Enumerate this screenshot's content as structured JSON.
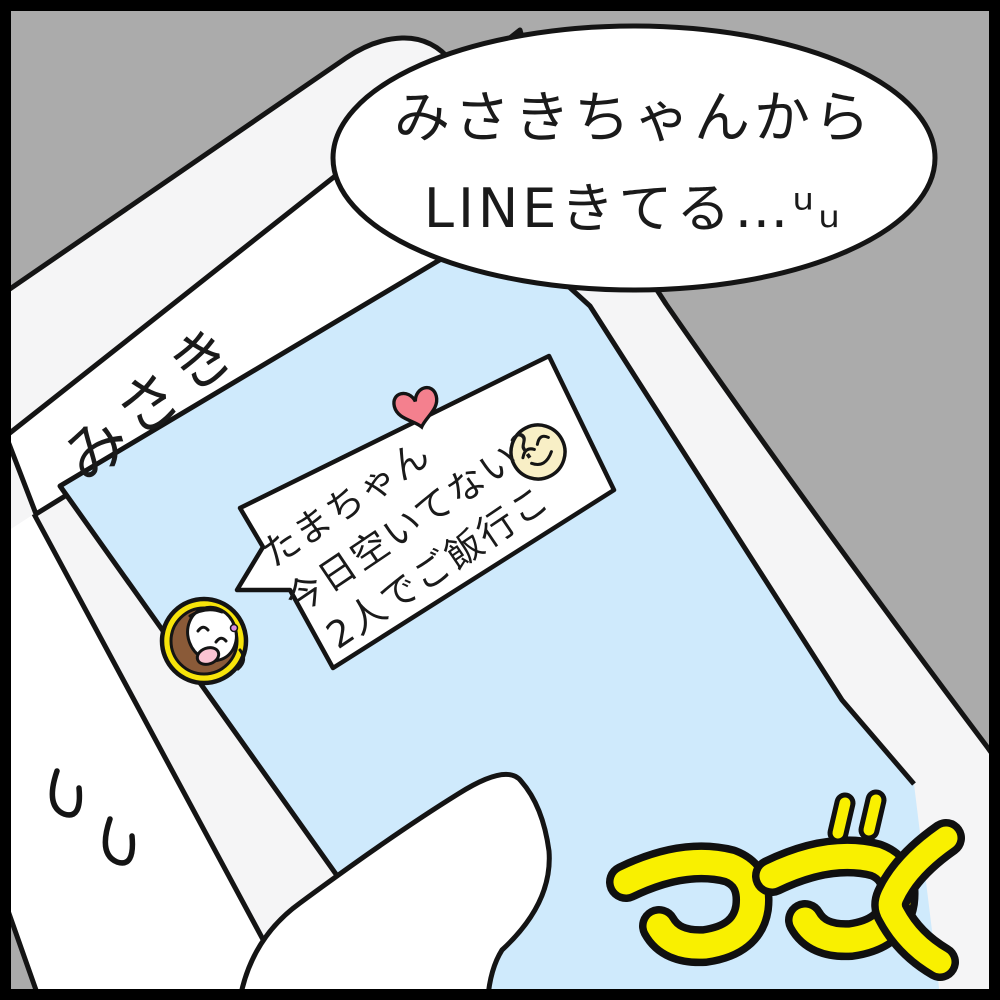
{
  "panel": {
    "kind": "hand-drawn comic panel",
    "background_color": "#ababab",
    "frame_color": "#000000"
  },
  "narration_bubble": {
    "line1": "みさきちゃんから",
    "line2": "LINEきてる…ᵘᵤ",
    "fill_color": "#ffffff"
  },
  "phone": {
    "body_color": "#f5f5f6",
    "header_label": "みさき",
    "screen_color": "#cfeafc"
  },
  "chat_message": {
    "line1": "たまちゃん",
    "line2": "今日空いてない?",
    "line3": "2人でご飯行こ",
    "bubble_color": "#ffffff",
    "heart_color": "#f4808e",
    "smiley_color": "#f8efc6"
  },
  "avatar": {
    "ring_color": "#f7e40a",
    "hair_color": "#8a5a38"
  },
  "continued_mark": {
    "text": "つづく",
    "fill_color": "#f9f000",
    "outline_color": "#101010"
  },
  "icons": {
    "heart": "heart-icon",
    "smiley": "smiling-face-icon",
    "avatar": "girl-avatar-icon",
    "hand_marks": "double-u-emphasis-marks"
  }
}
